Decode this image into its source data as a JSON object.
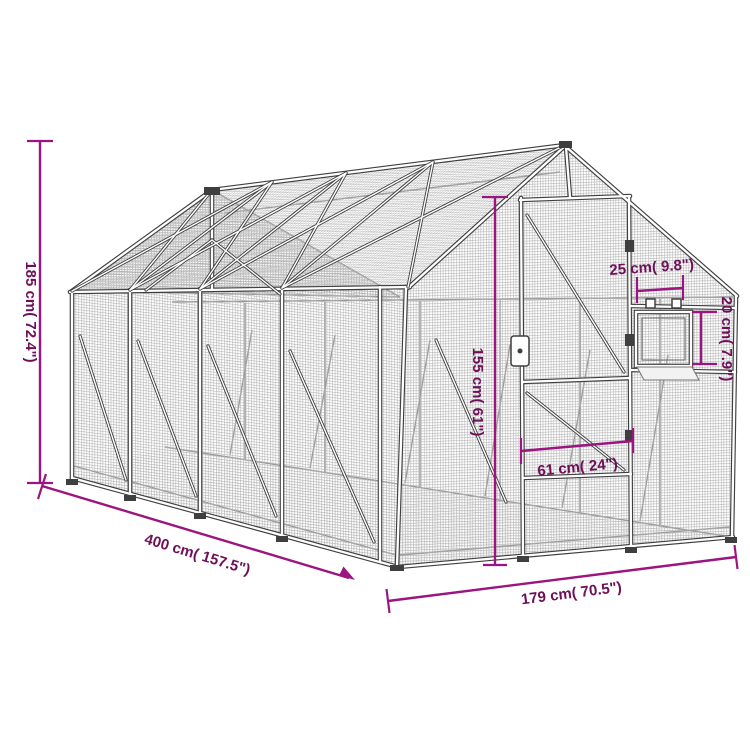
{
  "diagram": {
    "kind": "product-dimension-line-drawing",
    "subject": "mesh aviary / walk-in cage with gable roof, door and small hatch window"
  },
  "dimensions": {
    "height": {
      "label": "185 cm( 72.4\")"
    },
    "length": {
      "label": "400 cm( 157.5\")"
    },
    "width": {
      "label": "179 cm( 70.5\")"
    },
    "door_height": {
      "label": "155 cm( 61\")"
    },
    "door_width": {
      "label": "61 cm( 24\")"
    },
    "hatch_width": {
      "label": "25 cm( 9.8\")"
    },
    "hatch_height": {
      "label": "20 cm( 7.9\")"
    }
  },
  "colors": {
    "background": "#ffffff",
    "dimension_line": "#9c1480",
    "dimension_text": "#6e1058",
    "frame_outline": "#3f3f3f",
    "frame_fill": "#ffffff",
    "mesh": "#b2b2b2",
    "interior_lines": "#969696"
  }
}
